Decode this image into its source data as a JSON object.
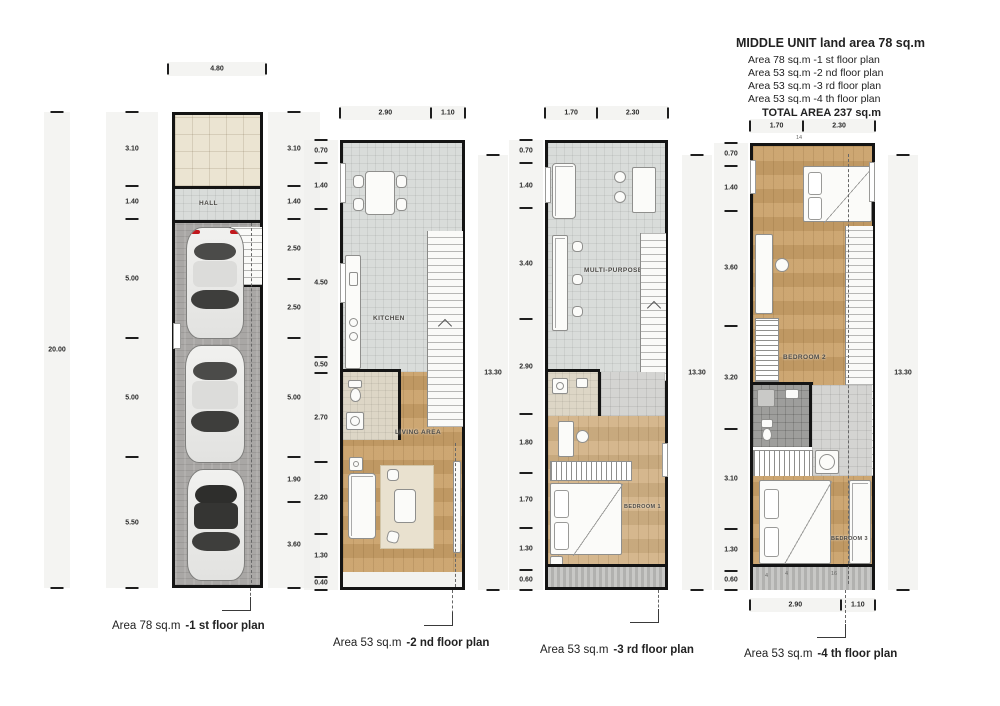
{
  "header": {
    "title": "MIDDLE UNIT land area 78 sq.m",
    "lines": [
      "Area 78 sq.m  -1 st floor plan",
      "Area 53 sq.m  -2 nd floor plan",
      "Area 53 sq.m  -3 rd floor plan",
      "Area 53 sq.m  -4 th floor plan"
    ],
    "total": "TOTAL AREA 237 sq.m"
  },
  "plans": [
    {
      "caption": {
        "area": "Area 78 sq.m",
        "label": "-1 st floor plan"
      },
      "top_dims": [
        "4.80"
      ],
      "overall_left": [
        "20.00"
      ],
      "left_dims": [
        "3.10",
        "1.40",
        "5.00",
        "5.00",
        "5.50"
      ],
      "right_dims": [
        "3.10",
        "1.40",
        "2.50",
        "2.50",
        "5.00",
        "1.90",
        "3.60"
      ],
      "rooms": {
        "hall": "HALL"
      }
    },
    {
      "caption": {
        "area": "Area 53 sq.m",
        "label": "-2 nd floor plan"
      },
      "top_dims": [
        "2.90",
        "1.10"
      ],
      "left_dims": [
        "0.70",
        "1.40",
        "4.50",
        "0.50",
        "2.70",
        "2.20",
        "1.30",
        "0.40"
      ],
      "right_overall": [
        "13.30"
      ],
      "rooms": {
        "kitchen": "KITCHEN",
        "living": "LIVING AREA"
      }
    },
    {
      "caption": {
        "area": "Area 53 sq.m",
        "label": "-3 rd floor plan"
      },
      "top_dims": [
        "1.70",
        "2.30"
      ],
      "left_dims": [
        "0.70",
        "1.40",
        "3.40",
        "2.90",
        "1.80",
        "1.70",
        "1.30",
        "0.60"
      ],
      "right_overall": [
        "13.30"
      ],
      "rooms": {
        "multi": "MULTI-PURPOSE",
        "bed1": "BEDROOM 1"
      }
    },
    {
      "caption": {
        "area": "Area 53 sq.m",
        "label": "-4 th floor plan"
      },
      "top_dims": [
        "1.70",
        "2.30"
      ],
      "bottom_dims": [
        "2.90",
        "1.10"
      ],
      "left_dims": [
        "0.70",
        "1.40",
        "3.60",
        "3.20",
        "3.10",
        "1.30",
        "0.60"
      ],
      "right_overall": [
        "13.30"
      ],
      "rooms": {
        "bed2": "BEDROOM 2",
        "bed3": "BEDROOM 3"
      },
      "top_tag": "14",
      "balcony_tags": [
        "4",
        "4",
        "16"
      ]
    }
  ],
  "colors": {
    "wall": "#141414",
    "wood": "#c9a068",
    "tile_beige": "#ebe4d2",
    "tile_gray": "#d9dcda",
    "paver": "#a9a7a5",
    "bath_dark": "#9e9e9c",
    "tail_light_red": "#c0171c"
  }
}
